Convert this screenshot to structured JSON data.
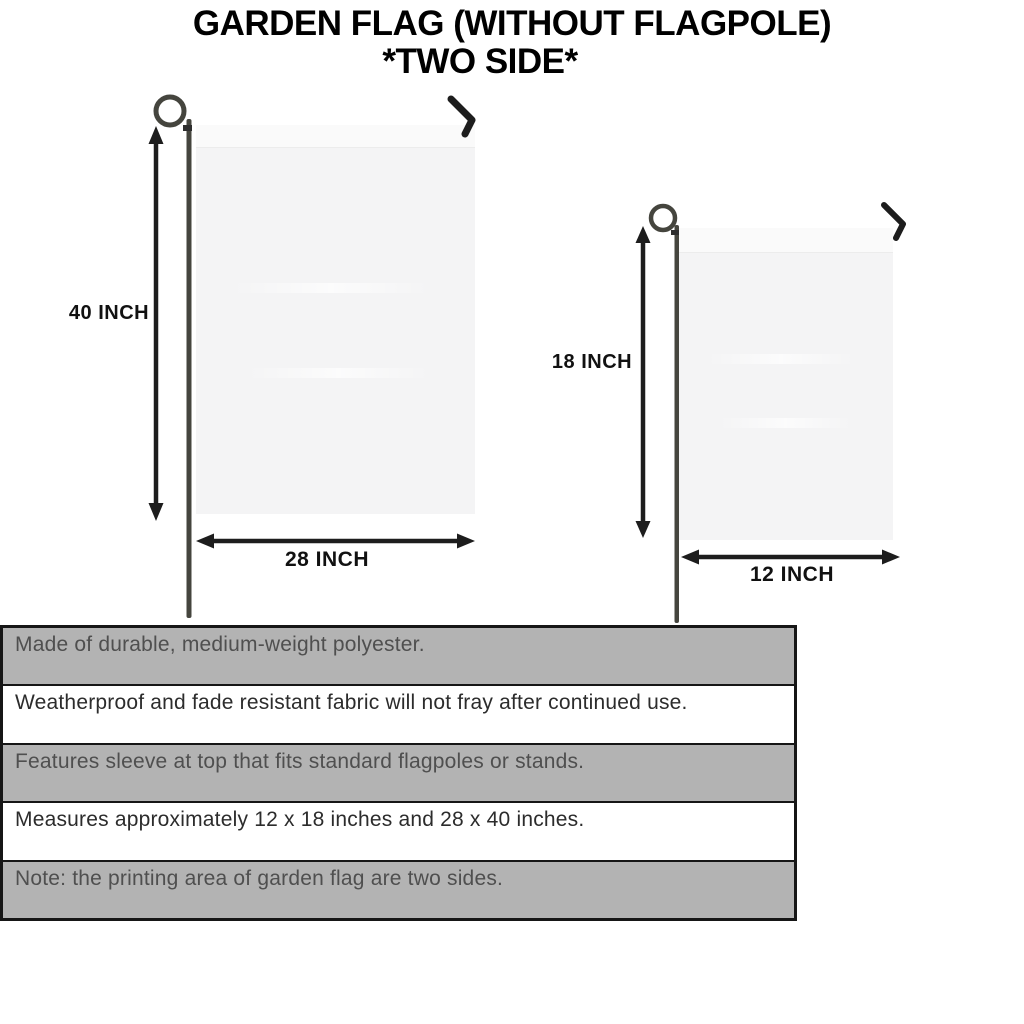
{
  "title": {
    "line1": "GARDEN FLAG (WITHOUT FLAGPOLE)",
    "line2": "*TWO SIDE*"
  },
  "flags": [
    {
      "name": "large",
      "height_label": "40 INCH",
      "width_label": "28 INCH"
    },
    {
      "name": "small",
      "height_label": "18 INCH",
      "width_label": "12 INCH"
    }
  ],
  "features": [
    {
      "text": "Made of durable, medium-weight polyester."
    },
    {
      "text": "Weatherproof and fade resistant fabric will not fray after continued use."
    },
    {
      "text": "Features sleeve at top that fits standard flagpoles or stands."
    },
    {
      "text": "Measures approximately 12 x 18 inches and 28 x 40 inches."
    },
    {
      "text": "Note: the printing area of garden flag are two sides."
    }
  ],
  "icons": {
    "pole_loop": "flagpole-loop",
    "pole": "flagpole-stake",
    "hanger_hook": "hanger-hook",
    "dimension_arrow": "double-headed-arrow"
  },
  "colors": {
    "background": "#ffffff",
    "title_text": "#000000",
    "flag_fabric": "#f4f4f5",
    "pole": "#45453e",
    "hook": "#1d1d1d",
    "arrow": "#1d1d1d",
    "table_border": "#161616",
    "table_row_gray": "#b3b3b3",
    "feature_text_on_white": "#2c2c2c",
    "feature_text_on_gray": "#4f4f4f"
  }
}
